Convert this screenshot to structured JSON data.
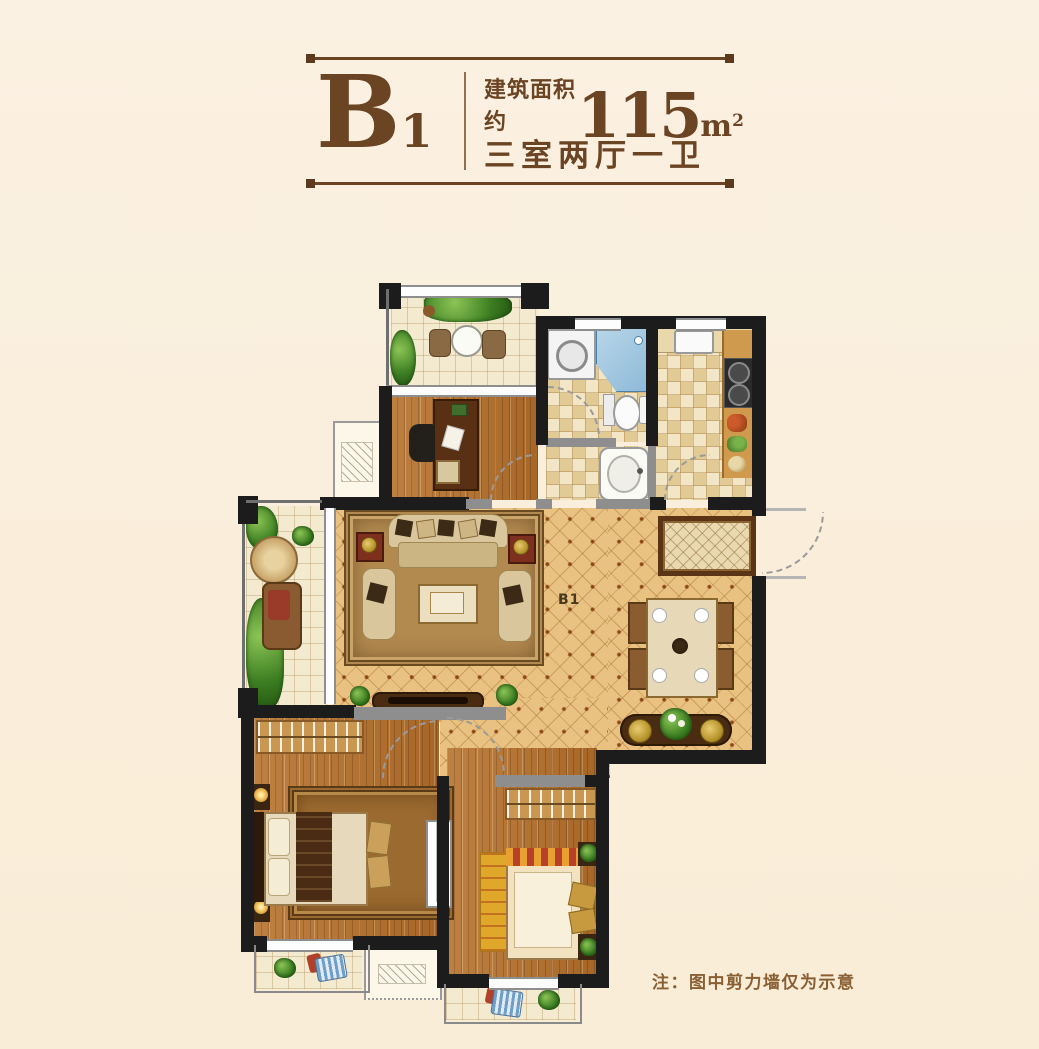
{
  "title": {
    "unit_letter": "B",
    "unit_number": "1",
    "area_prefix": "建筑面积约",
    "area_value": "115",
    "area_unit": "m",
    "area_exponent": "2",
    "spec": "三室两厅一卫"
  },
  "plan": {
    "watermark": "B1"
  },
  "note": {
    "text": "注：图中剪力墙仅为示意"
  },
  "colors": {
    "page_background": "#FAEFDD",
    "brand_brown": "#6B4423",
    "note_brown": "#8A5F33",
    "wall_black": "#1C1C1C",
    "wall_grey": "#8E8E8E",
    "wood_floor": "#B5712C",
    "tile_floor": "#EFE0BB",
    "diamond_tile": "#E9C180",
    "shower_blue": "#9CC6E0"
  }
}
